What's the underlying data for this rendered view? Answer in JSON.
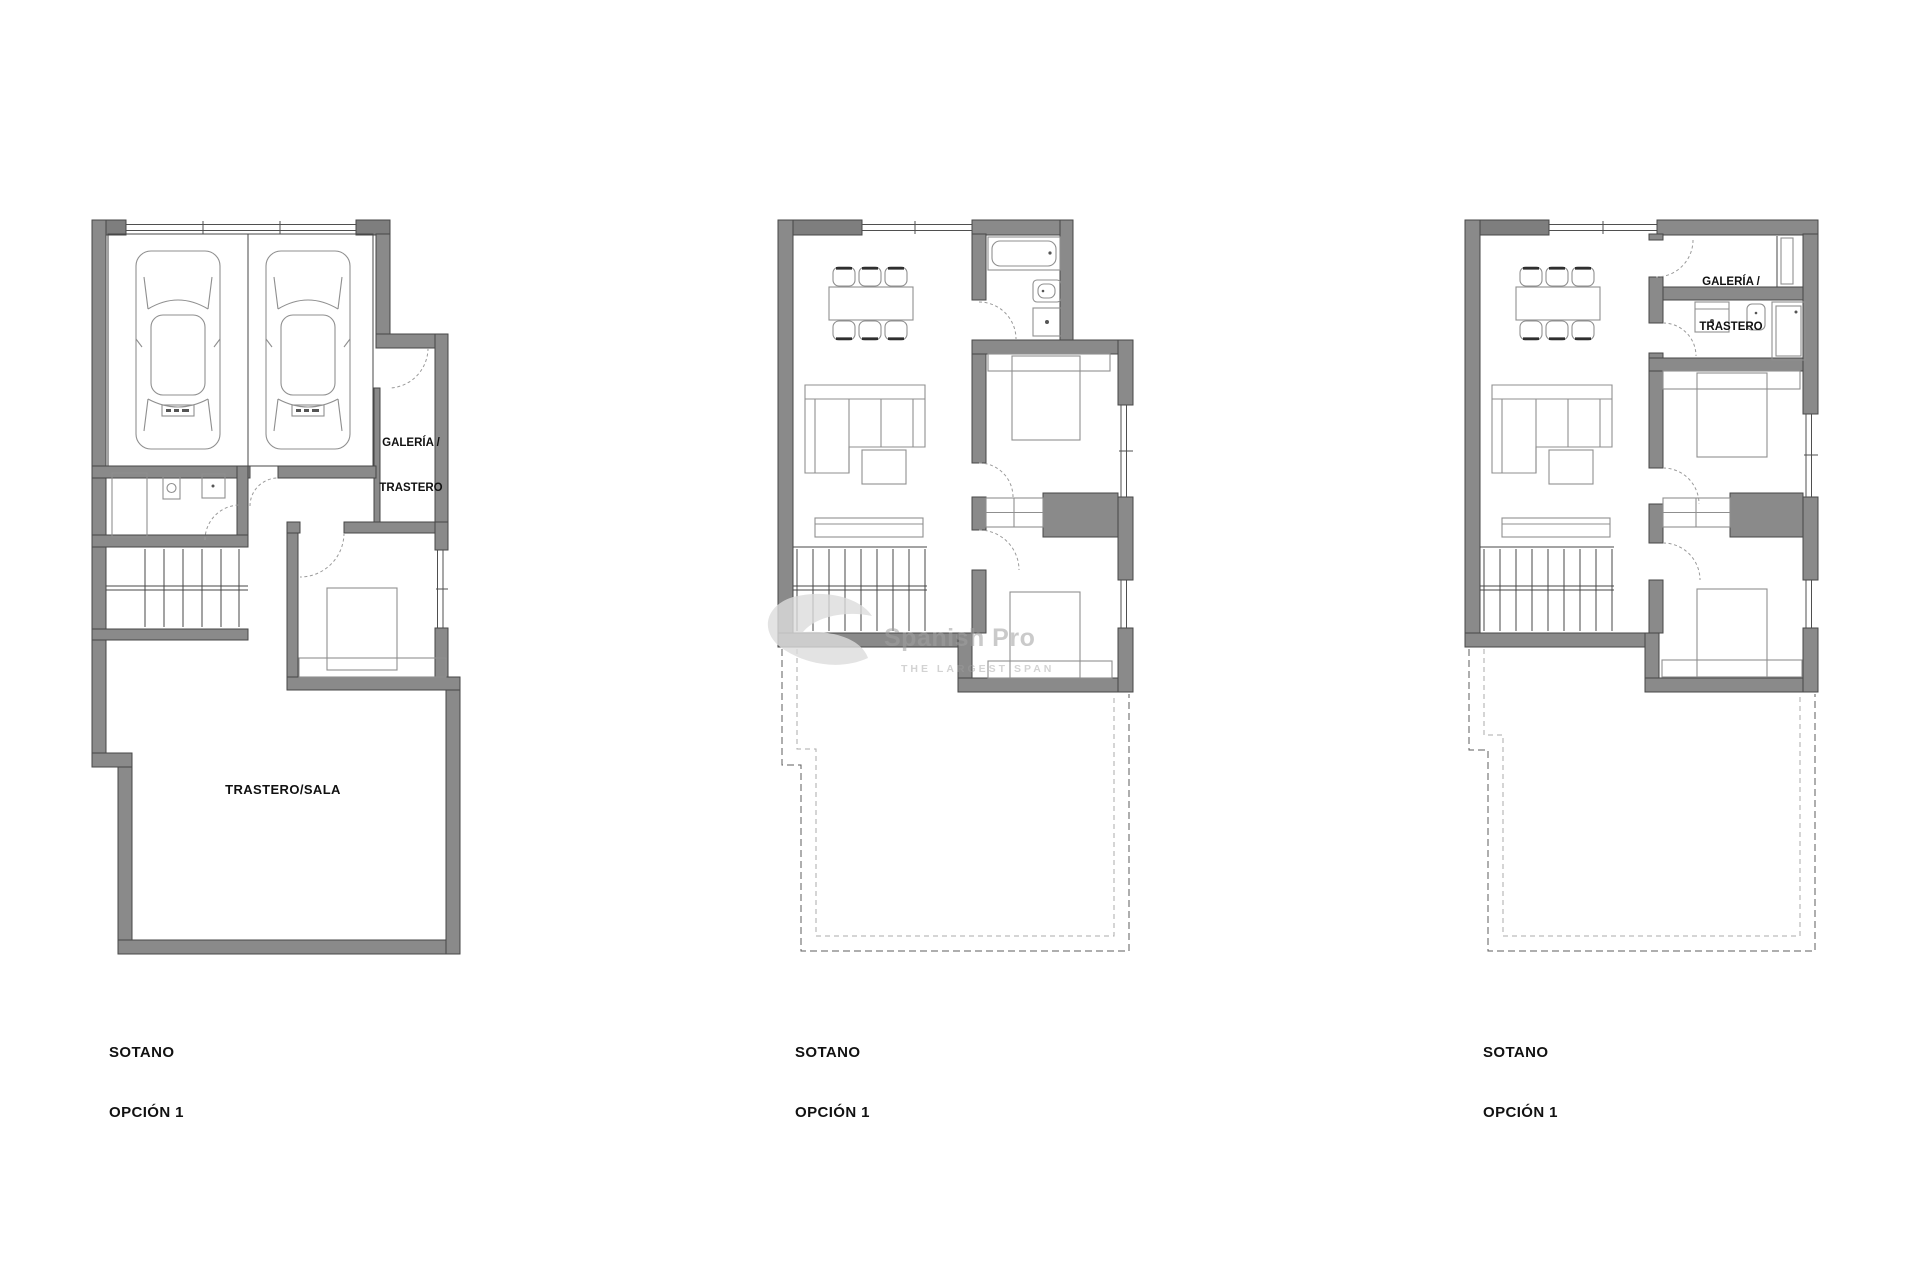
{
  "colors": {
    "background": "#ffffff",
    "wall": "#8a8a8a",
    "wall_dark": "#7e7e7e",
    "edge": "#474747",
    "furn": "#8f8f8f",
    "door": "#9a9a9a",
    "window_line": "#4f4f4f",
    "dash_outer": "#5c5c5c",
    "dash_inner": "#ababab",
    "label": "#111111",
    "watermark_text": "#a0a0a0",
    "watermark_logo": "#dcdcdc"
  },
  "watermark": {
    "line1": "Spanish Pro",
    "line2": "THE LARGEST SPAN"
  },
  "plans": [
    {
      "id": "left",
      "caption_line1": "SOTANO",
      "caption_line2": "OPCIÓN 1",
      "rooms": {
        "galeria_line1": "GALERÍA /",
        "galeria_line2": "TRASTERO",
        "sala": "TRASTERO/SALA"
      }
    },
    {
      "id": "middle",
      "caption_line1": "SOTANO",
      "caption_line2": "OPCIÓN 1",
      "rooms": {}
    },
    {
      "id": "right",
      "caption_line1": "SOTANO",
      "caption_line2": "OPCIÓN 1",
      "rooms": {
        "galeria_line1": "GALERÍA /",
        "galeria_line2": "TRASTERO"
      }
    }
  ]
}
